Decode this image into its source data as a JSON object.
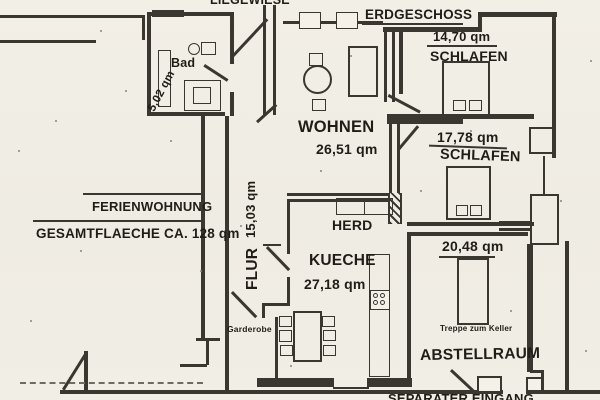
{
  "plan": {
    "site_label": "LIEGEWIESE",
    "floor_label": "ERDGESCHOSS",
    "unit": {
      "name": "FERIENWOHNUNG",
      "total_area": "GESAMTFLAECHE CA. 128 qm"
    },
    "rooms": [
      {
        "name": "SCHLAFEN",
        "area": "14,70 qm"
      },
      {
        "name": "SCHLAFEN",
        "area": "17,78 qm"
      },
      {
        "name": "Bad",
        "area": "5,02 qm"
      },
      {
        "name": "WOHNEN",
        "area": "26,51 qm"
      },
      {
        "name": "FLUR",
        "area": "15,03 qm"
      },
      {
        "name": "KUECHE",
        "area": "27,18 qm"
      },
      {
        "name": "ABSTELLRAUM",
        "area": "20,48 qm"
      }
    ],
    "annotations": {
      "herd": "HERD",
      "garderobe": "Garderobe",
      "treppe_zum_keller": "Treppe zum Keller",
      "eingang": "SEPARATER EINGANG"
    },
    "colors": {
      "ink": "#3a3731",
      "paper": "#f1eee5"
    }
  }
}
